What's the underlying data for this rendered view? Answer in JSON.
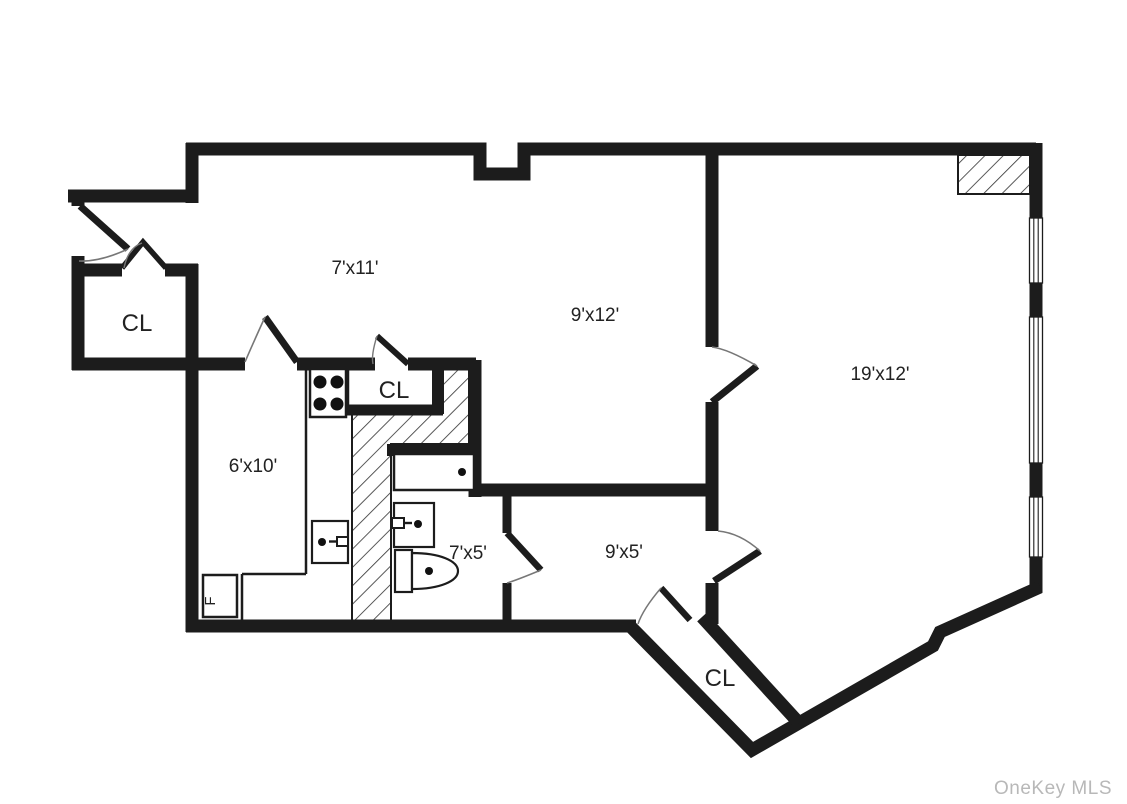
{
  "floor_plan": {
    "rooms": [
      {
        "id": "foyer",
        "label": "7'x11'"
      },
      {
        "id": "dining-room",
        "label": "9'x12'"
      },
      {
        "id": "living-room",
        "label": "19'x12'"
      },
      {
        "id": "kitchen",
        "label": "6'x10'"
      },
      {
        "id": "bathroom",
        "label": "7'x5'"
      },
      {
        "id": "hallway",
        "label": "9'x5'"
      }
    ],
    "closets": [
      {
        "id": "entry-closet",
        "label": "CL"
      },
      {
        "id": "kitchen-closet",
        "label": "CL"
      },
      {
        "id": "corner-closet",
        "label": "CL"
      }
    ],
    "fixtures": {
      "refrigerator_label": "F"
    },
    "watermark": "OneKey MLS",
    "colors": {
      "wall": "#1c1c1c",
      "background": "#ffffff",
      "watermark": "#b8b8b8",
      "label_text": "#222222"
    }
  }
}
